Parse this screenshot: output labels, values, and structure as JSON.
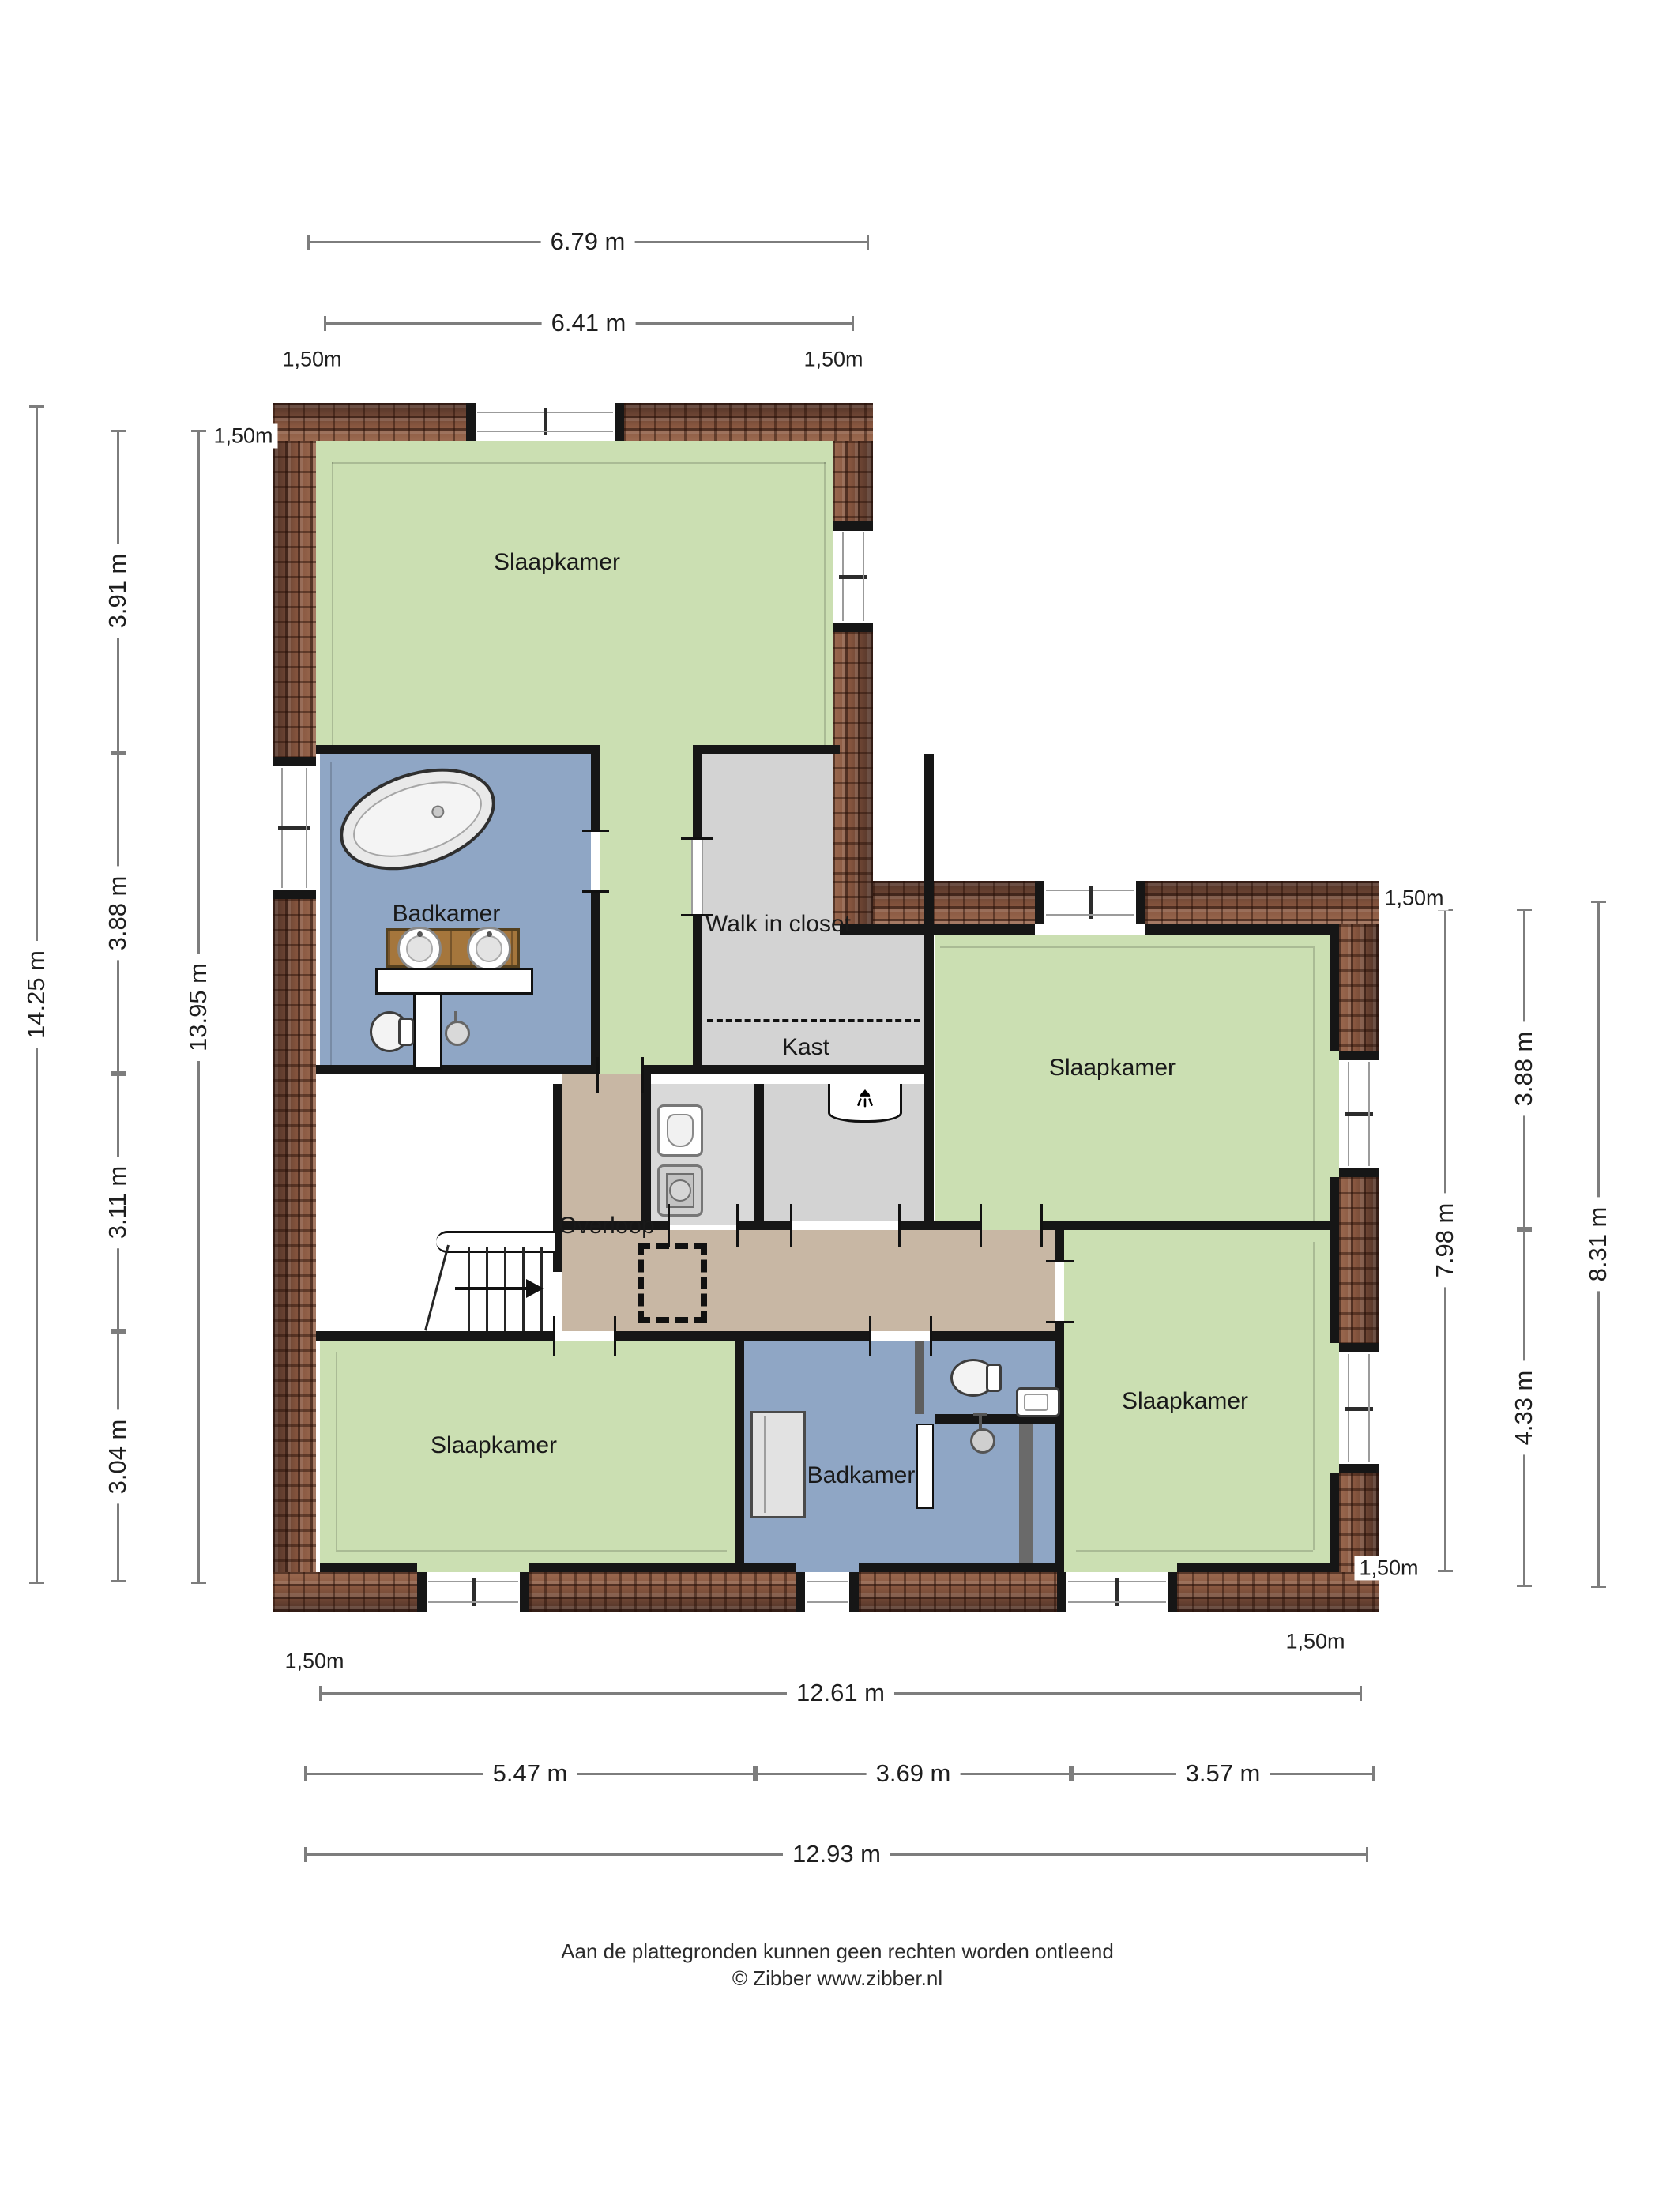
{
  "rooms": [
    {
      "id": "slaapkamer-top",
      "label": "Slaapkamer"
    },
    {
      "id": "badkamer-top",
      "label": "Badkamer"
    },
    {
      "id": "walk-in-closet",
      "label": "Walk in closet"
    },
    {
      "id": "kast",
      "label": "Kast"
    },
    {
      "id": "slaapkamer-right",
      "label": "Slaapkamer"
    },
    {
      "id": "overloop",
      "label": "Overloop"
    },
    {
      "id": "slaapkamer-bottom-left",
      "label": "Slaapkamer"
    },
    {
      "id": "badkamer-bottom",
      "label": "Badkamer"
    },
    {
      "id": "slaapkamer-bottom-right",
      "label": "Slaapkamer"
    }
  ],
  "dimensions": {
    "top": [
      {
        "label": "6.79 m"
      },
      {
        "label": "6.41 m"
      }
    ],
    "left": [
      {
        "label": "14.25 m"
      },
      {
        "label": "3.91 m"
      },
      {
        "label": "3.88 m"
      },
      {
        "label": "3.11 m"
      },
      {
        "label": "3.04 m"
      },
      {
        "label": "13.95 m"
      }
    ],
    "right": [
      {
        "label": "7.98 m"
      },
      {
        "label": "3.88 m"
      },
      {
        "label": "4.33 m"
      },
      {
        "label": "8.31 m"
      }
    ],
    "bottom": [
      {
        "label": "12.61 m"
      },
      {
        "label": "5.47 m"
      },
      {
        "label": "3.69 m"
      },
      {
        "label": "3.57 m"
      },
      {
        "label": "12.93 m"
      }
    ],
    "offset_label": "1,50m"
  },
  "footer": {
    "disclaimer": "Aan de plattegronden kunnen geen rechten worden ontleend",
    "copyright": "© Zibber www.zibber.nl"
  },
  "colors": {
    "room_green": "#cbdfb2",
    "room_blue": "#8fa6c5",
    "floor_tan": "#c8b7a4",
    "closet_gray": "#d3d3d3",
    "roof_brown": "#7a513f",
    "wall": "#161616",
    "dimension_line": "#7d7d7d"
  }
}
